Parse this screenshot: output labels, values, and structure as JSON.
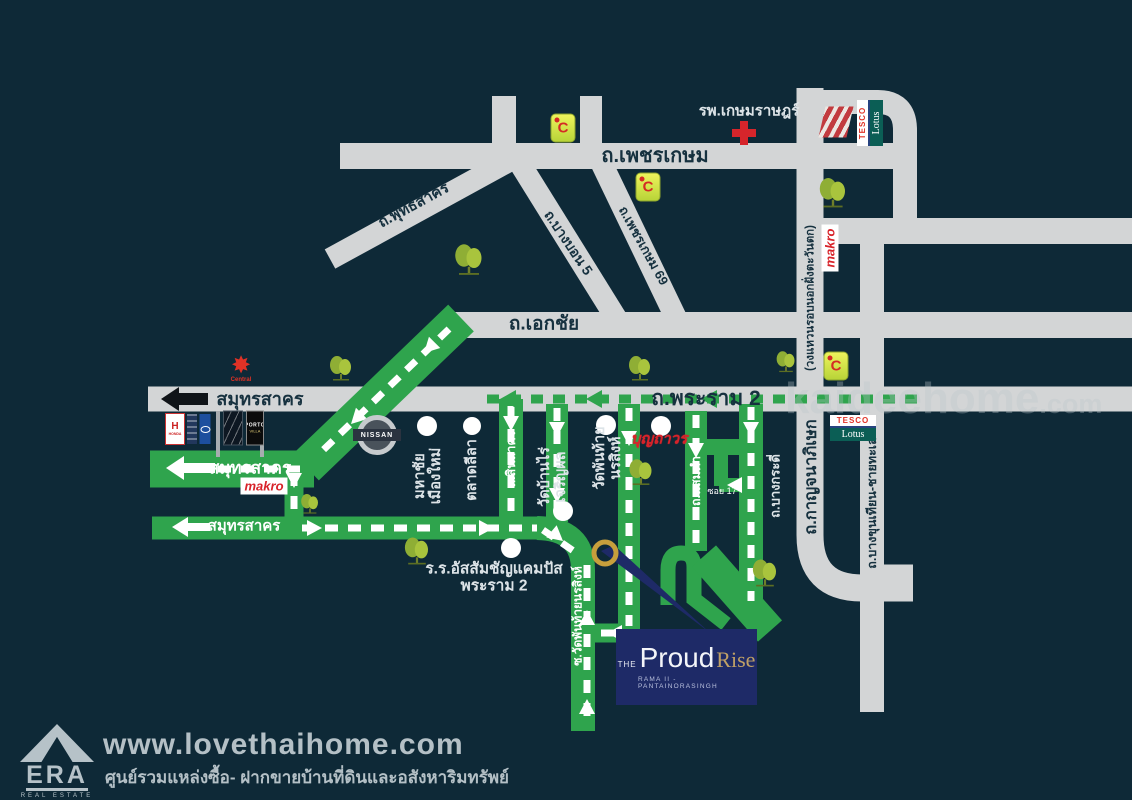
{
  "canvas": {
    "width": 1132,
    "height": 800,
    "bg": "#0e2937"
  },
  "colors": {
    "road_gray": "#d3d5d6",
    "route_green": "#2fa44d",
    "accent_red": "#d8232a",
    "project_navy": "#1e2a67",
    "gold": "#c79f3c",
    "label_dark": "#16313f"
  },
  "watermark": {
    "text": "kaideehome",
    "suffix": ".com"
  },
  "roads": {
    "phetkasem": "ถ.เพชรเกษม",
    "phuttha_sakhon": "ถ.พุทธสาคร",
    "bang_bon_5": "ถ.บางบอน 5",
    "phetkasem_69": "ถ.เพชรเกษม 69",
    "ekkachai": "ถ.เอกชัย",
    "rama2": "ถ.พระราม 2",
    "samut_sakhon": "สมุทรสาคร",
    "kanchanaphisek": "ถ.กาญจนาภิเษก",
    "ring_road_note": "(วงแหวนรอบนอกฝั่งตะวันตก)",
    "bang_khun_thian": "ถ.บางขุนเทียน-ชายทะเล",
    "bang_kradi": "ถ.บางกระดี่",
    "sin_sakhon": "ถ.สินสาคร",
    "samae_dam": "ถ.แสมดำ",
    "soi_17": "ซอย 17",
    "soi_wat_phanthai": "ซ.วัดพันท้ายนรสิงห์"
  },
  "places": {
    "hospital": "รพ.เกษมราษฎร์",
    "mahachai": "มหาชัย\nเมืองใหม่",
    "talat_leela": "ตลาดลีลา",
    "wat_ban_rai": "วัดบ้านไร่\nเจริญผล",
    "wat_phanthai": "วัดพันท้าย\nนรสิงห์",
    "assumption": "ร.ร.อัสสัมชัญแคมปัส\nพระราม 2",
    "boonthavorn": "บุญถาวร"
  },
  "logos": {
    "big_c_letter": "C",
    "central": "Central",
    "central_icon": "✸",
    "honda_letter": "H",
    "honda": "HONDA",
    "nissan": "NISSAN",
    "makro": "makro",
    "tesco": "TESCO",
    "lotus": "Lotus",
    "porto_line1": "PORTO",
    "porto_line2": "VILLA"
  },
  "project": {
    "the": "THE",
    "name": "Proud",
    "name2": "Rise",
    "subtitle": "RAMA II - PANTAINORASINGH"
  },
  "footer": {
    "era": "ERA",
    "era_sub": "REAL ESTATE",
    "site": "www.lovethaihome.com",
    "tagline": "ศูนย์รวมแหล่งซื้อ- ฝากขายบ้านที่ดินและอสังหาริมทรัพย์"
  }
}
